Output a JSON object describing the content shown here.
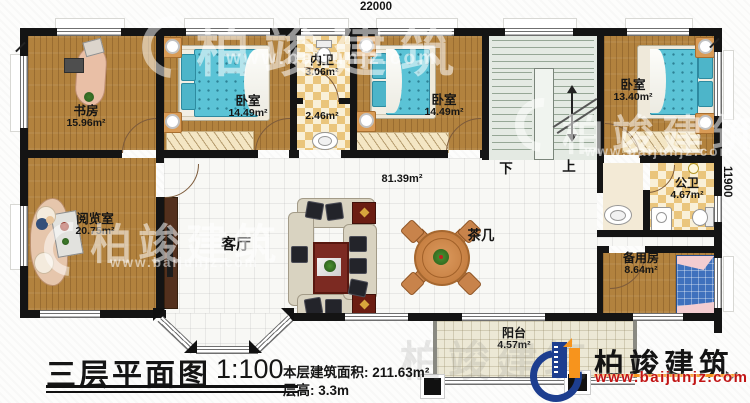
{
  "dimensions": {
    "top": "22000",
    "right": "11900"
  },
  "rooms": {
    "study": {
      "name": "书房",
      "area": "15.96m²"
    },
    "bedroom1": {
      "name": "卧室",
      "area": "14.49m²"
    },
    "inner_bath": {
      "name": "内卫",
      "area": "3.06m²"
    },
    "hall": {
      "area": "2.46m²"
    },
    "bedroom2": {
      "name": "卧室",
      "area": "14.49m²"
    },
    "bedroom3": {
      "name": "卧室",
      "area": "13.40m²"
    },
    "public_bath": {
      "name": "公卫",
      "area": "4.67m²"
    },
    "reading_room": {
      "name": "阅览室",
      "area": "20.75m²"
    },
    "living_room": {
      "name": "客厅",
      "area": "81.39m²"
    },
    "tea_table": {
      "name": "茶几"
    },
    "spare_room": {
      "name": "备用房",
      "area": "8.64m²"
    },
    "balcony": {
      "name": "阳台",
      "area": "4.57m²"
    }
  },
  "stairs": {
    "down": "下",
    "up": "上"
  },
  "title_block": {
    "title": "三层平面图",
    "scale": "1:100",
    "area_label": "本层建筑面积:",
    "area_value": "211.63m²",
    "floor_height_label": "层高:",
    "floor_height_value": "3.3m"
  },
  "logo": {
    "brand": "柏竣建筑",
    "website": "www.baijunjz.com"
  },
  "watermark": {
    "brand": "柏竣建筑",
    "website": "www.baijunjz.com"
  },
  "colors": {
    "wall": "#141414",
    "wood": "#b2823e",
    "tile": "#f8f8f5",
    "checker": "#eac57c",
    "stair": "#e4eae3",
    "balcony": "#ece8d5",
    "mattress": "#5bc3d6",
    "logo_blue": "#1d3e8f",
    "logo_orange": "#f7941d",
    "url_red": "#c11414"
  }
}
